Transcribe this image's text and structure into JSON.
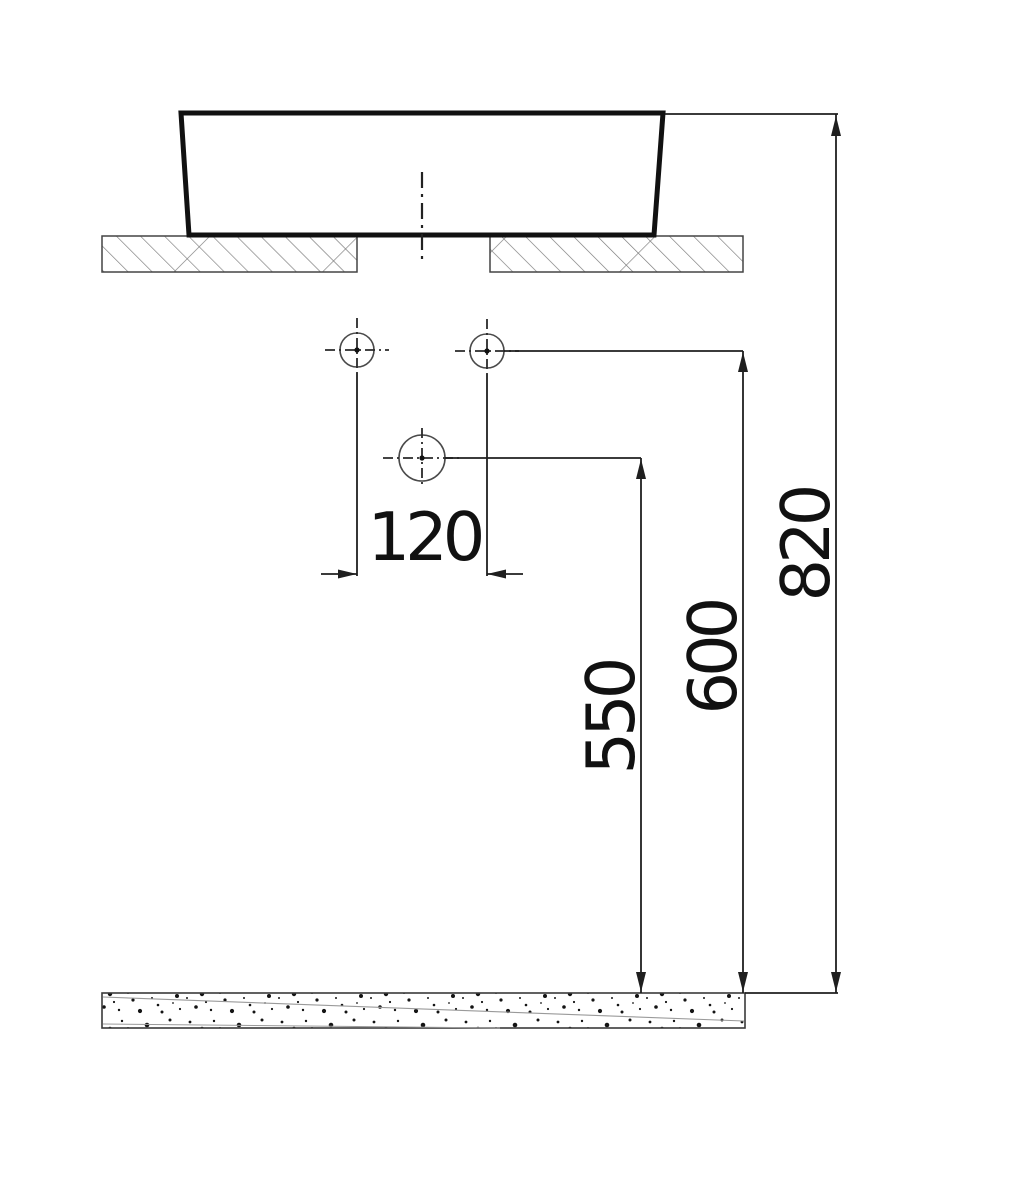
{
  "dimensions": {
    "hole_spacing_mm": "120",
    "drain_outlet_height_mm": "550",
    "water_supply_height_mm": "600",
    "basin_rim_height_mm": "820"
  },
  "colors": {
    "line": "#1f1f1f",
    "basin_line": "#111111",
    "hatch": "#787878",
    "background": "#ffffff"
  }
}
